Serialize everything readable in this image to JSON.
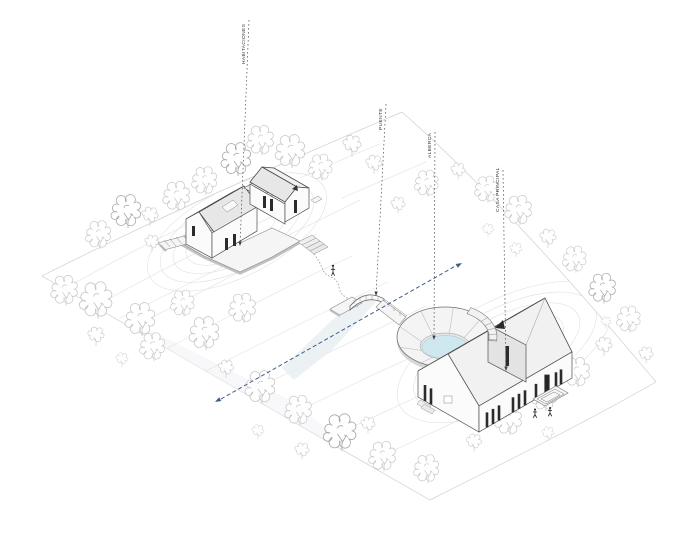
{
  "page": {
    "type": "architectural-axonometric-site-diagram"
  },
  "labels": {
    "habitaciones": "HABITACIONES",
    "puente": "PUENTE",
    "alberca": "ALBERCA",
    "casa_principal": "CASA PRINCIPAL"
  },
  "colors": {
    "background": "#ffffff",
    "ink": "#444444",
    "leader": "#4a4a4a",
    "label_text": "#3a3a3a",
    "arrow_blue": "#3f5d85",
    "pool_water": "#cfe8ef",
    "stream": "#e9eff2",
    "contour": "#dedede",
    "tree": "#c7c7c7",
    "tree_dark": "#a9a9a9",
    "wall": "#fbfbfb",
    "wall_shade": "#e3e3e3",
    "roof_light": "#f1f1f1",
    "roof_shade": "#e7e7e7",
    "window_dark": "#2b2b2b",
    "deck": "#f5f5f5",
    "deck_edge": "#c2c2c2"
  }
}
